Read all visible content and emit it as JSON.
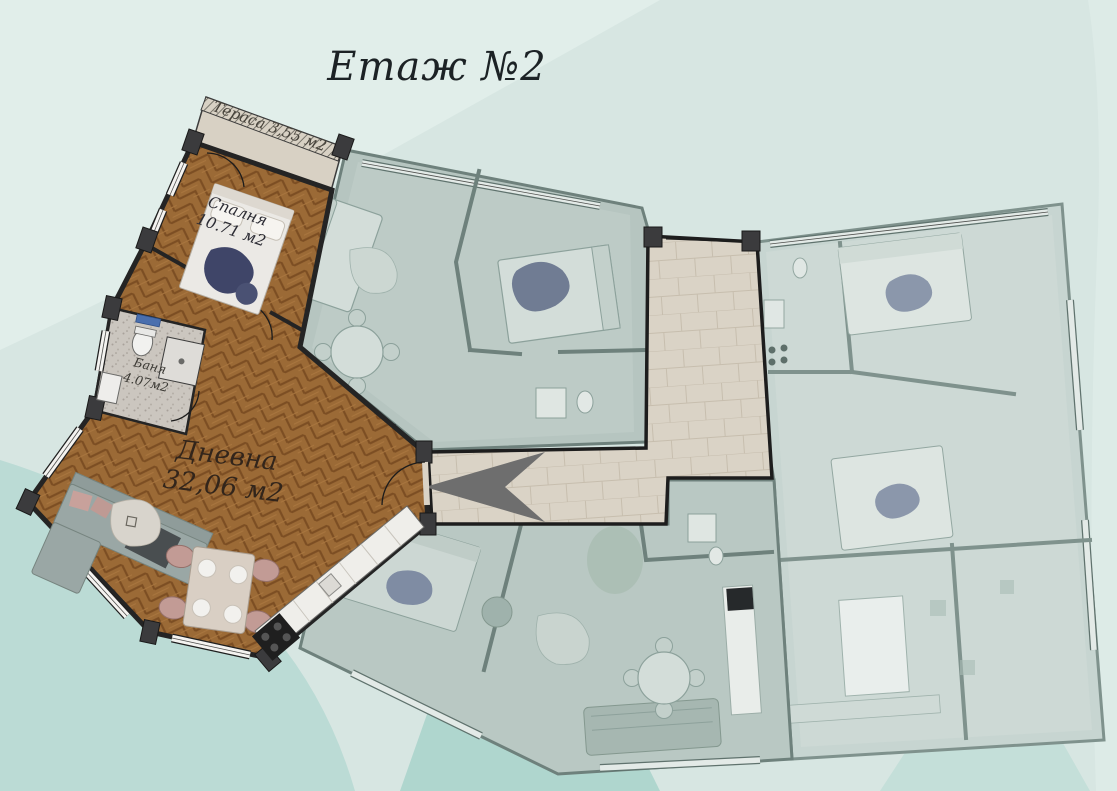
{
  "title": "Етаж №2",
  "active_apartment": {
    "terrace": {
      "label": "Тераса 3,55 м2",
      "name": "Тераса",
      "area": "3,55 м2"
    },
    "bedroom": {
      "name": "Спалня",
      "area": "10.71 м2"
    },
    "bathroom": {
      "name": "Баня",
      "area": "4.07м2"
    },
    "living_room": {
      "name": "Дневна",
      "area": "32,06 м2"
    }
  },
  "icons": {
    "entrance_arrow": "◀"
  },
  "colors": {
    "background": "#d7e6e2",
    "background_waves": [
      "#e1eeea",
      "#bbdbd5",
      "#a8d2ca"
    ],
    "active_wood_floor": "#9b6a36",
    "active_walls": "#242424",
    "corridor_tiles": "#dad3c6",
    "muted_unit_fill": "#b6c5c0",
    "muted_unit_walls": "#6e817c",
    "right_unit_fill": "#c7d5d1",
    "entrance_arrow": "#6e6e6e",
    "bed_navy": "#3f4568",
    "sofa_gray": "#9aa7a5",
    "chair_pink": "#c29b95"
  }
}
